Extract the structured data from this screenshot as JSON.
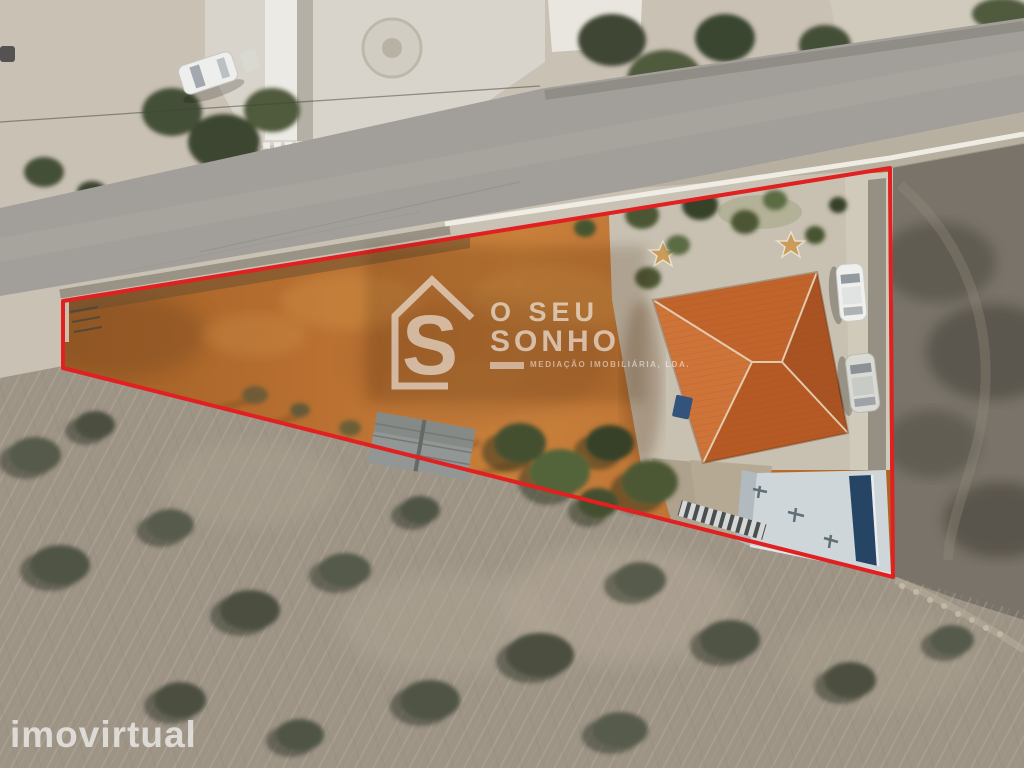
{
  "page": {
    "kind": "real-estate listing photograph",
    "view": "top-down aerial drone photo of a triangular land plot outlined in red, with house, yard and surrounding roads and scrub fields"
  },
  "watermarks": {
    "agency": {
      "icon": "house-s-logo",
      "icon_letter": "S",
      "line1": "O SEU",
      "line2": "SONHO",
      "tagline": "MEDIAÇÃO IMOBILIÁRIA, LDA."
    },
    "portal": {
      "label": "imovirtual"
    }
  },
  "colors": {
    "boundary_red": "#e0181c",
    "soil_orange": "#bc7231",
    "soil_orange_dark": "#8f5424",
    "roof_tile": "#b5541f",
    "warehouse_roof": "#ccd6da",
    "warehouse_stripe": "#1e3e60",
    "road_asphalt": "#9f9c97",
    "ground_sand": "#c9c2b5",
    "courtyard": "#d8d4cb",
    "field_bottom": "#9a9184",
    "field_right": "#746f66",
    "tree_green": "#44512f",
    "watermark_white": "#ffffff"
  },
  "scene": {
    "elements": [
      "asphalt-road",
      "white-roadside-wall",
      "red-plot-boundary",
      "bare-soil-plot",
      "garden-trees",
      "star-paving-ornaments",
      "hip-roof-house",
      "gravel-yard",
      "parked-cars",
      "metal-shed",
      "warehouse-roof-with-blue-stripe",
      "striped-walkway",
      "scrub-field-right",
      "dry-grass-field-bottom",
      "courtyard-with-fountain",
      "white-parked-car"
    ]
  }
}
